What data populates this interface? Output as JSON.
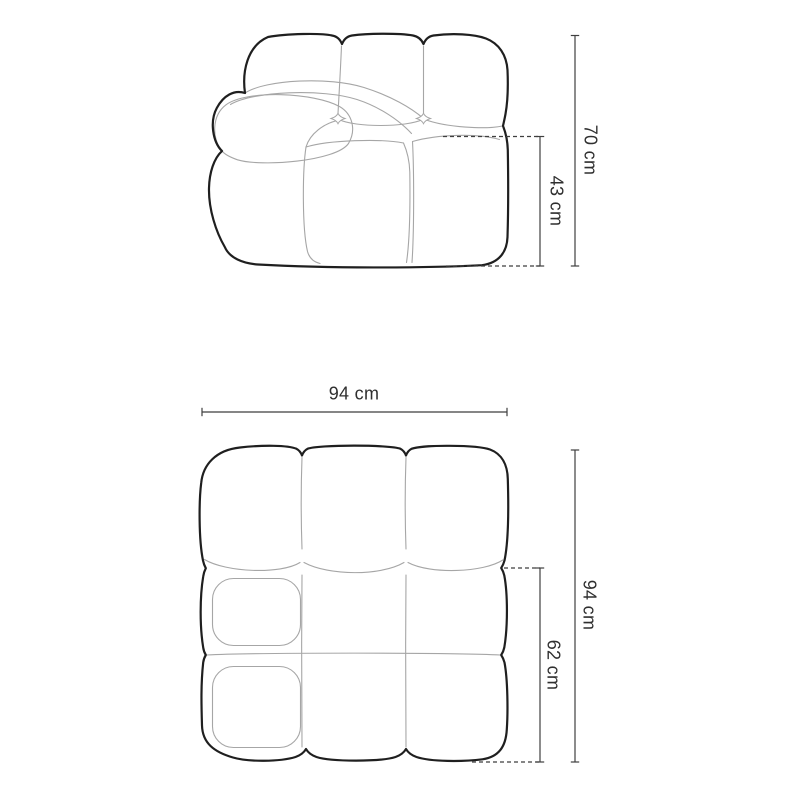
{
  "colors": {
    "background": "#ffffff",
    "outline": "#1f1f1f",
    "seam": "#a6a6a6",
    "dimension": "#3f3f3f",
    "label": "#2f2f2f"
  },
  "front_view": {
    "dimensions": {
      "total_height": "70 cm",
      "seat_height": "43 cm"
    }
  },
  "top_view": {
    "dimensions": {
      "width": "94 cm",
      "depth": "94 cm",
      "seat_depth": "62 cm"
    }
  }
}
